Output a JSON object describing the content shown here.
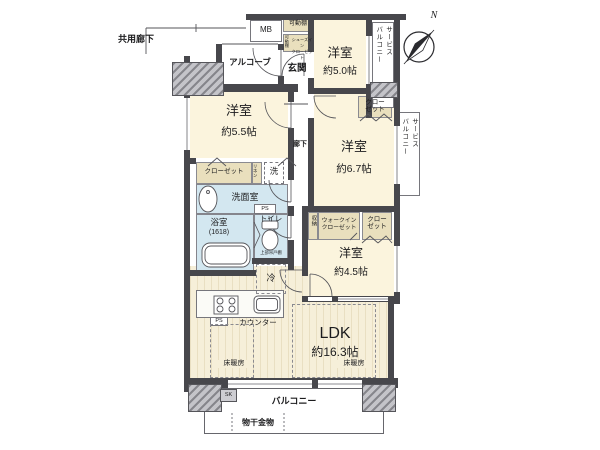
{
  "colors": {
    "wall": "#47474c",
    "room_cream": "#fbf4dd",
    "wet_blue": "#d3e7f0",
    "wood_floor": "#f6efd9",
    "closet_beige": "#e9dfbd"
  },
  "exterior": {
    "common_corridor": "共用廊下",
    "alcove": "アルコーブ",
    "meter_box": "MB",
    "compass_north": "N",
    "balcony": "バルコニー",
    "service_balcony": "サービス\nバルコニー",
    "drying_fixture": "物干金物",
    "slop_sink": "SK"
  },
  "entrance": {
    "genkan": "玄関",
    "shelf": "可動棚",
    "sic_shelf": "可動棚",
    "sic": "シューズイン\nクローゼット",
    "hallway": "廊下"
  },
  "rooms": {
    "west_50": {
      "name": "洋室",
      "size": "約5.0帖"
    },
    "west_55": {
      "name": "洋室",
      "size": "約5.5帖"
    },
    "west_67": {
      "name": "洋室",
      "size": "約6.7帖"
    },
    "west_45": {
      "name": "洋室",
      "size": "約4.5帖"
    },
    "ldk": {
      "name": "LDK",
      "size": "約16.3帖",
      "floor_heating": "床暖房",
      "counter": "カウンター",
      "fridge": "冷",
      "ps": "PS"
    }
  },
  "wet": {
    "washroom": "洗面室",
    "washer": "洗",
    "linen": "リネン",
    "bath": "浴室",
    "bath_size": "(1618)",
    "toilet": "トイレ",
    "toilet_note": "上部吊戸棚",
    "ps": "PS"
  },
  "storage": {
    "closet": "クローゼット",
    "closet_2line": "クロー\nゼット",
    "wic": "ウォークイン\nクローゼット",
    "shuno": "収納"
  }
}
